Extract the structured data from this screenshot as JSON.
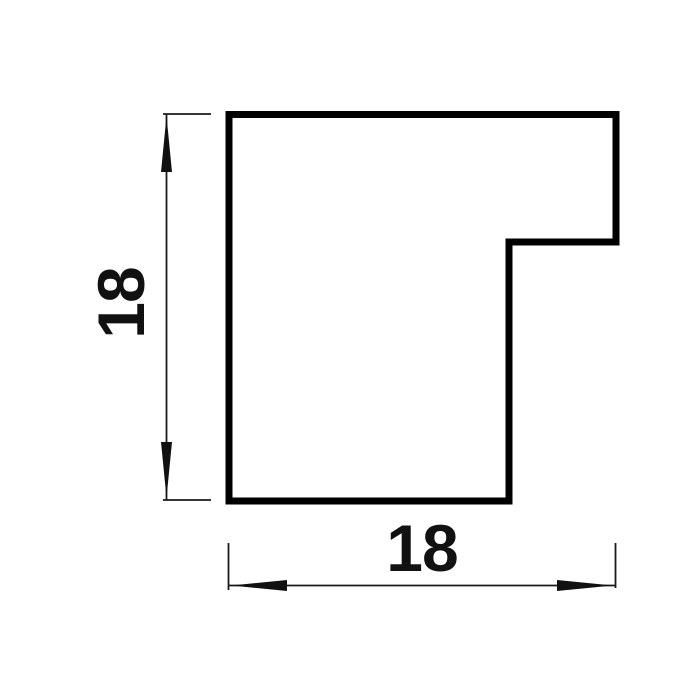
{
  "colors": {
    "background": "#ffffff",
    "profile_outline": "#000000",
    "dimension_lines": "#1a1a1a",
    "label_text": "#111111"
  },
  "labels": {
    "vertical_dimension": "18",
    "horizontal_dimension": "18"
  }
}
